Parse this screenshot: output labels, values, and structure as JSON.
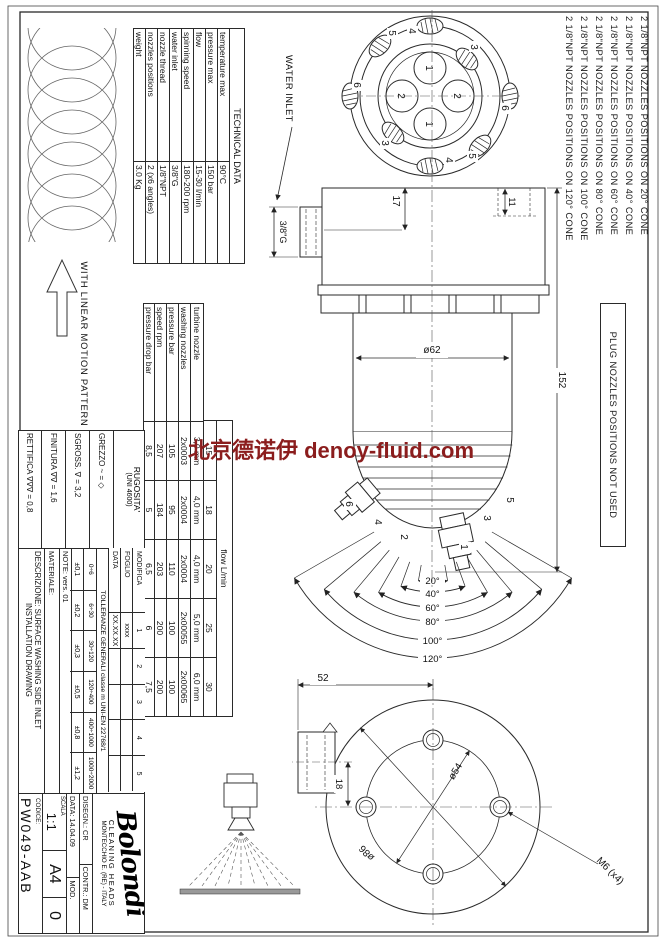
{
  "watermark": {
    "text": "北京德诺伊 denoy-fluid.com",
    "color": "#8b1d1d"
  },
  "notes": {
    "items": [
      "2 1/8\"NPT NOZZLES POSITIONS ON 20° CONE",
      "2 1/8\"NPT NOZZLES POSITIONS ON 40° CONE",
      "2 1/8\"NPT NOZZLES POSITIONS ON 60° CONE",
      "2 1/8\"NPT NOZZLES POSITIONS ON 80° CONE",
      "2 1/8\"NPT NOZZLES POSITIONS ON 100° CONE",
      "2 1/8\"NPT NOZZLES POSITIONS ON 120° CONE"
    ]
  },
  "plug_note": "PLUG NOZZLES POSITIONS NOT USED",
  "pattern": {
    "label": "WITH LINEAR MOTION PATTERN"
  },
  "water_inlet": "WATER INLET",
  "technical_data": {
    "title": "TECHNICAL DATA",
    "rows": [
      {
        "label": "temperature max",
        "value": "90°C"
      },
      {
        "label": "pressure max",
        "value": "150 bar"
      },
      {
        "label": "flow",
        "value": "15-30 l/min"
      },
      {
        "label": "spinning speed",
        "value": "180-200 rpm"
      },
      {
        "label": "water inlet",
        "value": "3/8\"G"
      },
      {
        "label": "nozzle thread",
        "value": "1/8\"NPT"
      },
      {
        "label": "nozzles positions",
        "value": "2 (x6 angles)"
      },
      {
        "label": "weight",
        "value": "3.0 Kg"
      }
    ]
  },
  "turbine_table": {
    "flow_label": "flow  L/min",
    "flow_values": [
      "15",
      "18",
      "20",
      "25",
      "30"
    ],
    "rows": [
      {
        "label": "turbine nozzle",
        "values": [
          "3,0 mm",
          "4,0 mm",
          "4,0 mm",
          "5,0 mm",
          "6,0 mm"
        ]
      },
      {
        "label": "washing nozzles",
        "values": [
          "2x0003",
          "2x0004",
          "2x0004",
          "2x00055",
          "2x00065"
        ]
      },
      {
        "label": "pressure bar",
        "values": [
          "105",
          "95",
          "110",
          "100",
          "100"
        ]
      },
      {
        "label": "speed rpm",
        "values": [
          "207",
          "184",
          "203",
          "200",
          "200"
        ]
      },
      {
        "label": "pressure drop bar",
        "values": [
          "8,5",
          "5",
          "6,5",
          "6",
          "7,5"
        ]
      }
    ]
  },
  "cones": {
    "labels": [
      "20°",
      "40°",
      "60°",
      "80°",
      "100°",
      "120°"
    ]
  },
  "positions": {
    "p1": "1",
    "p2": "2",
    "p3": "3",
    "p4": "4",
    "p5": "5",
    "p6": "6"
  },
  "dims": {
    "d17": "17",
    "d11": "11",
    "d152": "152",
    "d62": "ø62",
    "inlet_thread": "3/8\"G",
    "d52": "52",
    "d18": "18",
    "d54": "ø54",
    "d86": "ø86",
    "m6": "M6 (x4)"
  },
  "title_block": {
    "rugosita": {
      "title": "RUGOSITA'",
      "subtitle": "(UNI 4600)",
      "rows": [
        "GREZZO   ~ = ◇",
        "SGROSS.   ∇ = 3,2",
        "FINITURA   ∇∇ = 1,6",
        "RETTIFICA   ∇∇∇ = 0,8"
      ]
    },
    "modifica": {
      "headers": [
        "MODIFICA",
        "1",
        "2",
        "3",
        "4",
        "5"
      ],
      "foglio": {
        "label": "FOGLIO",
        "value": "xxxx"
      },
      "data": {
        "label": "DATA",
        "value": "XX.XX.XX"
      }
    },
    "tolleranze": {
      "title": "TOLLERANZE GENERALI classe m UNI-EN 22768/1",
      "ranges": [
        "0÷6",
        "6÷30",
        "30÷120",
        "120÷400",
        "400÷1000",
        "1000÷2000"
      ],
      "values": [
        "±0,1",
        "±0,2",
        "±0,3",
        "±0,5",
        "±0,8",
        "±1,2"
      ]
    },
    "note": "NOTE:  vers. 01",
    "materiale": "MATERIALE:",
    "descrizione": "DESCRIZIONE: SURFACE WASHING SIDE INLET",
    "descrizione2": "INSTALLATION DRAWING",
    "logo": "Bolondi",
    "tagline": "CLEANING HEADS",
    "address": "MONTECCHIO E. (RE) - ITALY",
    "disegn": "DISEGN.:  CR",
    "contr": "CONTR.:  DM",
    "data": "DATA:  14.04.09",
    "mod_label": "MOD.",
    "scala_label": "SCALA",
    "scala": "1:1",
    "codice_label": "CODICE:",
    "codice": "PW049-AAB",
    "format": "A4",
    "mod": "0"
  }
}
